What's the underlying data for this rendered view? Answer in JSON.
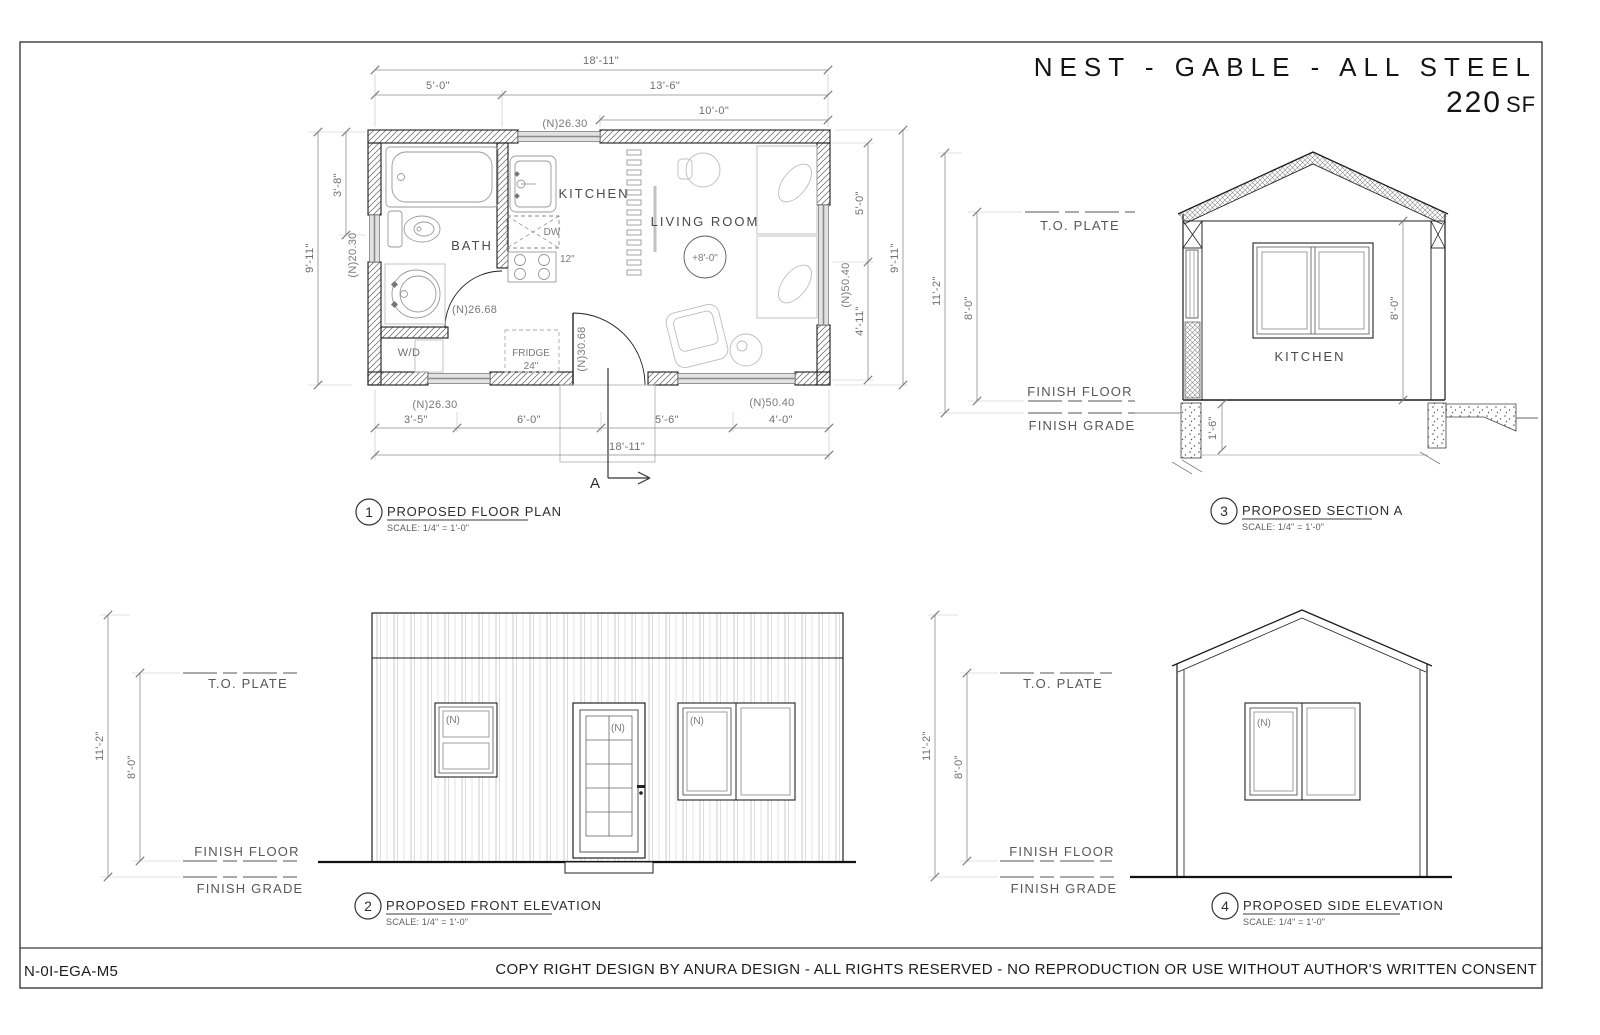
{
  "page": {
    "title": "NEST - GABLE - ALL STEEL",
    "area_number": "220",
    "area_unit": "SF",
    "sheet_code": "N-0I-EGA-M5",
    "copyright": "COPY RIGHT DESIGN BY ANURA DESIGN - ALL RIGHTS RESERVED - NO REPRODUCTION OR USE WITHOUT AUTHOR'S WRITTEN CONSENT"
  },
  "labels": {
    "to_plate": "T.O. PLATE",
    "finish_floor": "FINISH FLOOR",
    "finish_grade": "FINISH GRADE",
    "new_tag": "(N)",
    "scale_note": "SCALE: 1/4\" = 1'-0\"",
    "section_marker": "A"
  },
  "floor_plan": {
    "num": "1",
    "title": "PROPOSED FLOOR PLAN",
    "rooms": {
      "bath": "BATH",
      "kitchen": "KITCHEN",
      "living": "LIVING ROOM",
      "ceiling_height": "+8'-0\"",
      "wd": "W/D",
      "fridge": "FRIDGE",
      "fridge_size": "24\"",
      "dw": "DW",
      "range_size": "12\""
    },
    "dims": {
      "overall_w": "18'-11\"",
      "top_a": "5'-0\"",
      "top_b": "13'-6\"",
      "top_c": "10'-0\"",
      "left_overall": "9'-11\"",
      "left_a": "3'-8\"",
      "right_a": "5'-0\"",
      "right_b": "4'-11\"",
      "right_overall": "9'-11\"",
      "bot_a": "3'-5\"",
      "bot_b": "6'-0\"",
      "bot_c": "5'-6\"",
      "bot_d": "4'-0\"",
      "bot_overall": "18'-11\""
    },
    "tags": {
      "window_top": "(N)26.30",
      "window_left": "(N)20.30",
      "window_right": "(N)50.40",
      "window_bottom_left": "(N)26.30",
      "window_bottom_right": "(N)50.40",
      "bath_door": "(N)26.68",
      "entry_door": "(N)30.68"
    }
  },
  "section": {
    "num": "3",
    "title": "PROPOSED SECTION A",
    "room": "KITCHEN",
    "dims": {
      "overall_h": "11'-2\"",
      "wall_h": "8'-0\"",
      "interior_h": "8'-0\"",
      "foundation": "1'-6\""
    }
  },
  "front_elevation": {
    "num": "2",
    "title": "PROPOSED FRONT ELEVATION",
    "dims": {
      "overall_h": "11'-2\"",
      "wall_h": "8'-0\""
    }
  },
  "side_elevation": {
    "num": "4",
    "title": "PROPOSED SIDE ELEVATION",
    "dims": {
      "overall_h": "11'-2\"",
      "wall_h": "8'-0\""
    }
  }
}
